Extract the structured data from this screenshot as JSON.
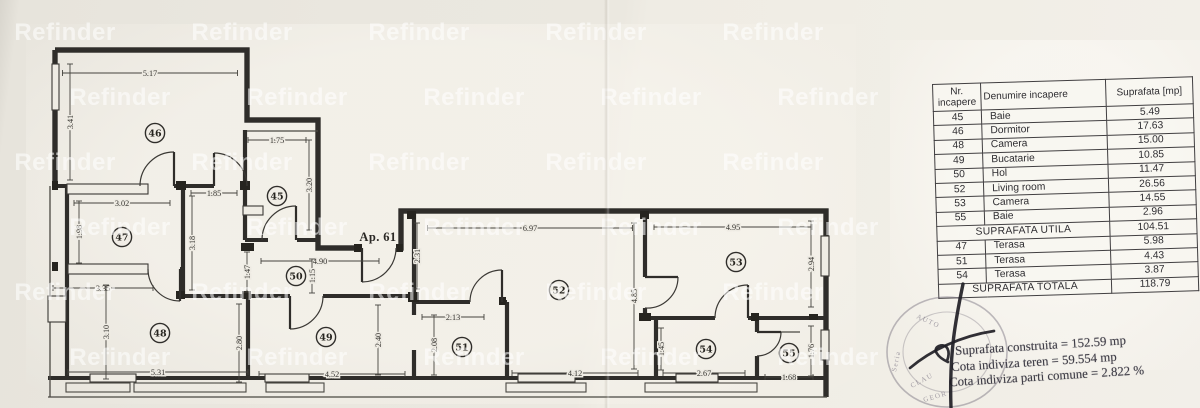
{
  "watermark": {
    "text": "Refinder"
  },
  "plan": {
    "apartment_label": "Ap. 61",
    "rooms": [
      {
        "num": "46",
        "x": 155,
        "y": 133
      },
      {
        "num": "45",
        "x": 277,
        "y": 196
      },
      {
        "num": "47",
        "x": 122,
        "y": 237
      },
      {
        "num": "50",
        "x": 296,
        "y": 276
      },
      {
        "num": "48",
        "x": 160,
        "y": 333
      },
      {
        "num": "49",
        "x": 326,
        "y": 337
      },
      {
        "num": "51",
        "x": 462,
        "y": 347
      },
      {
        "num": "52",
        "x": 559,
        "y": 290
      },
      {
        "num": "53",
        "x": 736,
        "y": 262
      },
      {
        "num": "54",
        "x": 706,
        "y": 349
      },
      {
        "num": "55",
        "x": 789,
        "y": 353
      }
    ],
    "dimensions": [
      {
        "text": "5.17",
        "x": 150,
        "y": 73,
        "len": 175,
        "vertical": false
      },
      {
        "text": "3.41",
        "x": 70,
        "y": 122,
        "len": 116,
        "vertical": true
      },
      {
        "text": "1.75",
        "x": 277,
        "y": 140,
        "len": 58,
        "vertical": false
      },
      {
        "text": "3.20",
        "x": 309,
        "y": 185,
        "len": 90,
        "vertical": true
      },
      {
        "text": "1.85",
        "x": 214,
        "y": 193,
        "len": 46,
        "vertical": false
      },
      {
        "text": "3.02",
        "x": 122,
        "y": 203,
        "len": 96,
        "vertical": false
      },
      {
        "text": "1.98",
        "x": 79,
        "y": 232,
        "len": 62,
        "vertical": true
      },
      {
        "text": "3.18",
        "x": 192,
        "y": 243,
        "len": 94,
        "vertical": true
      },
      {
        "text": "1.47",
        "x": 247,
        "y": 272,
        "len": 40,
        "vertical": true
      },
      {
        "text": "4.90",
        "x": 320,
        "y": 261,
        "len": 118,
        "vertical": false
      },
      {
        "text": "1.15",
        "x": 312,
        "y": 276,
        "len": 34,
        "vertical": true
      },
      {
        "text": "2.31",
        "x": 417,
        "y": 256,
        "len": 66,
        "vertical": true
      },
      {
        "text": "6.97",
        "x": 530,
        "y": 228,
        "len": 205,
        "vertical": false
      },
      {
        "text": "4.95",
        "x": 733,
        "y": 227,
        "len": 158,
        "vertical": false
      },
      {
        "text": "2.94",
        "x": 811,
        "y": 264,
        "len": 86,
        "vertical": true
      },
      {
        "text": "4.85",
        "x": 634,
        "y": 296,
        "len": 146,
        "vertical": true
      },
      {
        "text": "3.35",
        "x": 103,
        "y": 288,
        "len": 100,
        "vertical": false
      },
      {
        "text": "3.10",
        "x": 106,
        "y": 332,
        "len": 94,
        "vertical": true
      },
      {
        "text": "2.80",
        "x": 239,
        "y": 343,
        "len": 78,
        "vertical": true
      },
      {
        "text": "2.40",
        "x": 378,
        "y": 340,
        "len": 70,
        "vertical": true
      },
      {
        "text": "2.13",
        "x": 453,
        "y": 317,
        "len": 62,
        "vertical": false
      },
      {
        "text": "2.08",
        "x": 434,
        "y": 345,
        "len": 60,
        "vertical": true
      },
      {
        "text": "5.31",
        "x": 158,
        "y": 372,
        "len": 180,
        "vertical": false
      },
      {
        "text": "4.52",
        "x": 332,
        "y": 374,
        "len": 146,
        "vertical": false
      },
      {
        "text": "4.12",
        "x": 575,
        "y": 373,
        "len": 126,
        "vertical": false
      },
      {
        "text": "2.67",
        "x": 704,
        "y": 373,
        "len": 82,
        "vertical": false
      },
      {
        "text": "1.45",
        "x": 661,
        "y": 349,
        "len": 42,
        "vertical": true
      },
      {
        "text": "1.76",
        "x": 811,
        "y": 351,
        "len": 50,
        "vertical": true
      },
      {
        "text": "1.68",
        "x": 789,
        "y": 377,
        "len": 48,
        "vertical": false
      }
    ]
  },
  "table": {
    "headers": [
      "Nr. incapere",
      "Denumire incapere",
      "Suprafata [mp]"
    ],
    "rows": [
      {
        "nr": "45",
        "name": "Baie",
        "area": "5.49"
      },
      {
        "nr": "46",
        "name": "Dormitor",
        "area": "17.63"
      },
      {
        "nr": "48",
        "name": "Camera",
        "area": "15.00"
      },
      {
        "nr": "49",
        "name": "Bucatarie",
        "area": "10.85"
      },
      {
        "nr": "50",
        "name": "Hol",
        "area": "11.47"
      },
      {
        "nr": "52",
        "name": "Living room",
        "area": "26.56"
      },
      {
        "nr": "53",
        "name": "Camera",
        "area": "14.55"
      },
      {
        "nr": "55",
        "name": "Baie",
        "area": "2.96"
      },
      {
        "label": "SUPRAFATA UTILA",
        "area": "104.51"
      },
      {
        "nr": "47",
        "name": "Terasa",
        "area": "5.98"
      },
      {
        "nr": "51",
        "name": "Terasa",
        "area": "4.43"
      },
      {
        "nr": "54",
        "name": "Terasa",
        "area": "3.87"
      },
      {
        "label": "SUPRAFATA TOTALA",
        "area": "118.79"
      }
    ]
  },
  "stamp": {
    "lines": [
      "Suprafata construita = 152.59 mp",
      "Cota indiviza teren  = 59.554 mp",
      "Cota indiviza parti comune = 2.822 %"
    ],
    "seal_fragments": [
      "AUTO",
      "Seria",
      "CLAU",
      "GEOR"
    ]
  }
}
